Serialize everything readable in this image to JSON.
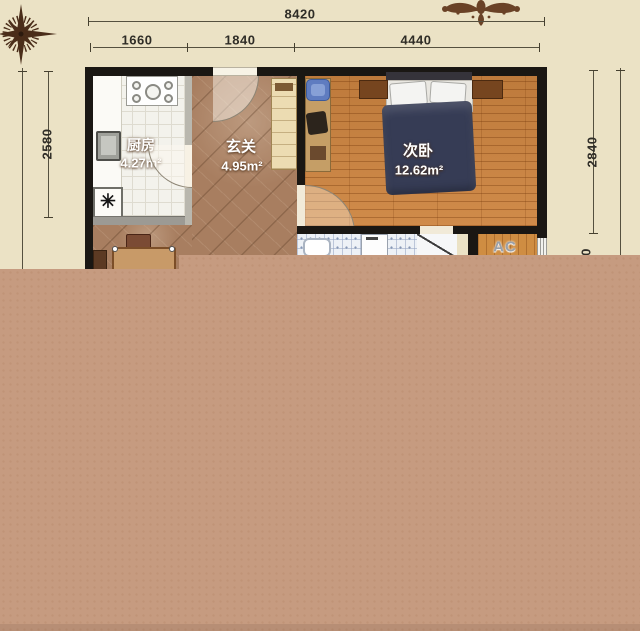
{
  "colors": {
    "background": "#ebe2c5",
    "overlay": "#c69b80",
    "wall": "#1a1713",
    "wood_floor": "#c8813f",
    "hall_tile": "#a87e60",
    "dimension_text": "#2f2d27"
  },
  "dimensions": {
    "top_total": "8420",
    "top_segments": [
      {
        "label": "1660"
      },
      {
        "label": "1840"
      },
      {
        "label": "4440"
      }
    ],
    "left_height": "2580",
    "right_height": "2840",
    "partial_digit": "0"
  },
  "rooms": {
    "kitchen": {
      "name": "厨房",
      "area": "4.27m²"
    },
    "hallway": {
      "name": "玄关",
      "area": "4.95m²"
    },
    "bedroom": {
      "name": "次卧",
      "area": "12.62m²"
    },
    "ac_unit": {
      "label": "AC"
    }
  },
  "symbols": {
    "floor_drain": "✳"
  }
}
